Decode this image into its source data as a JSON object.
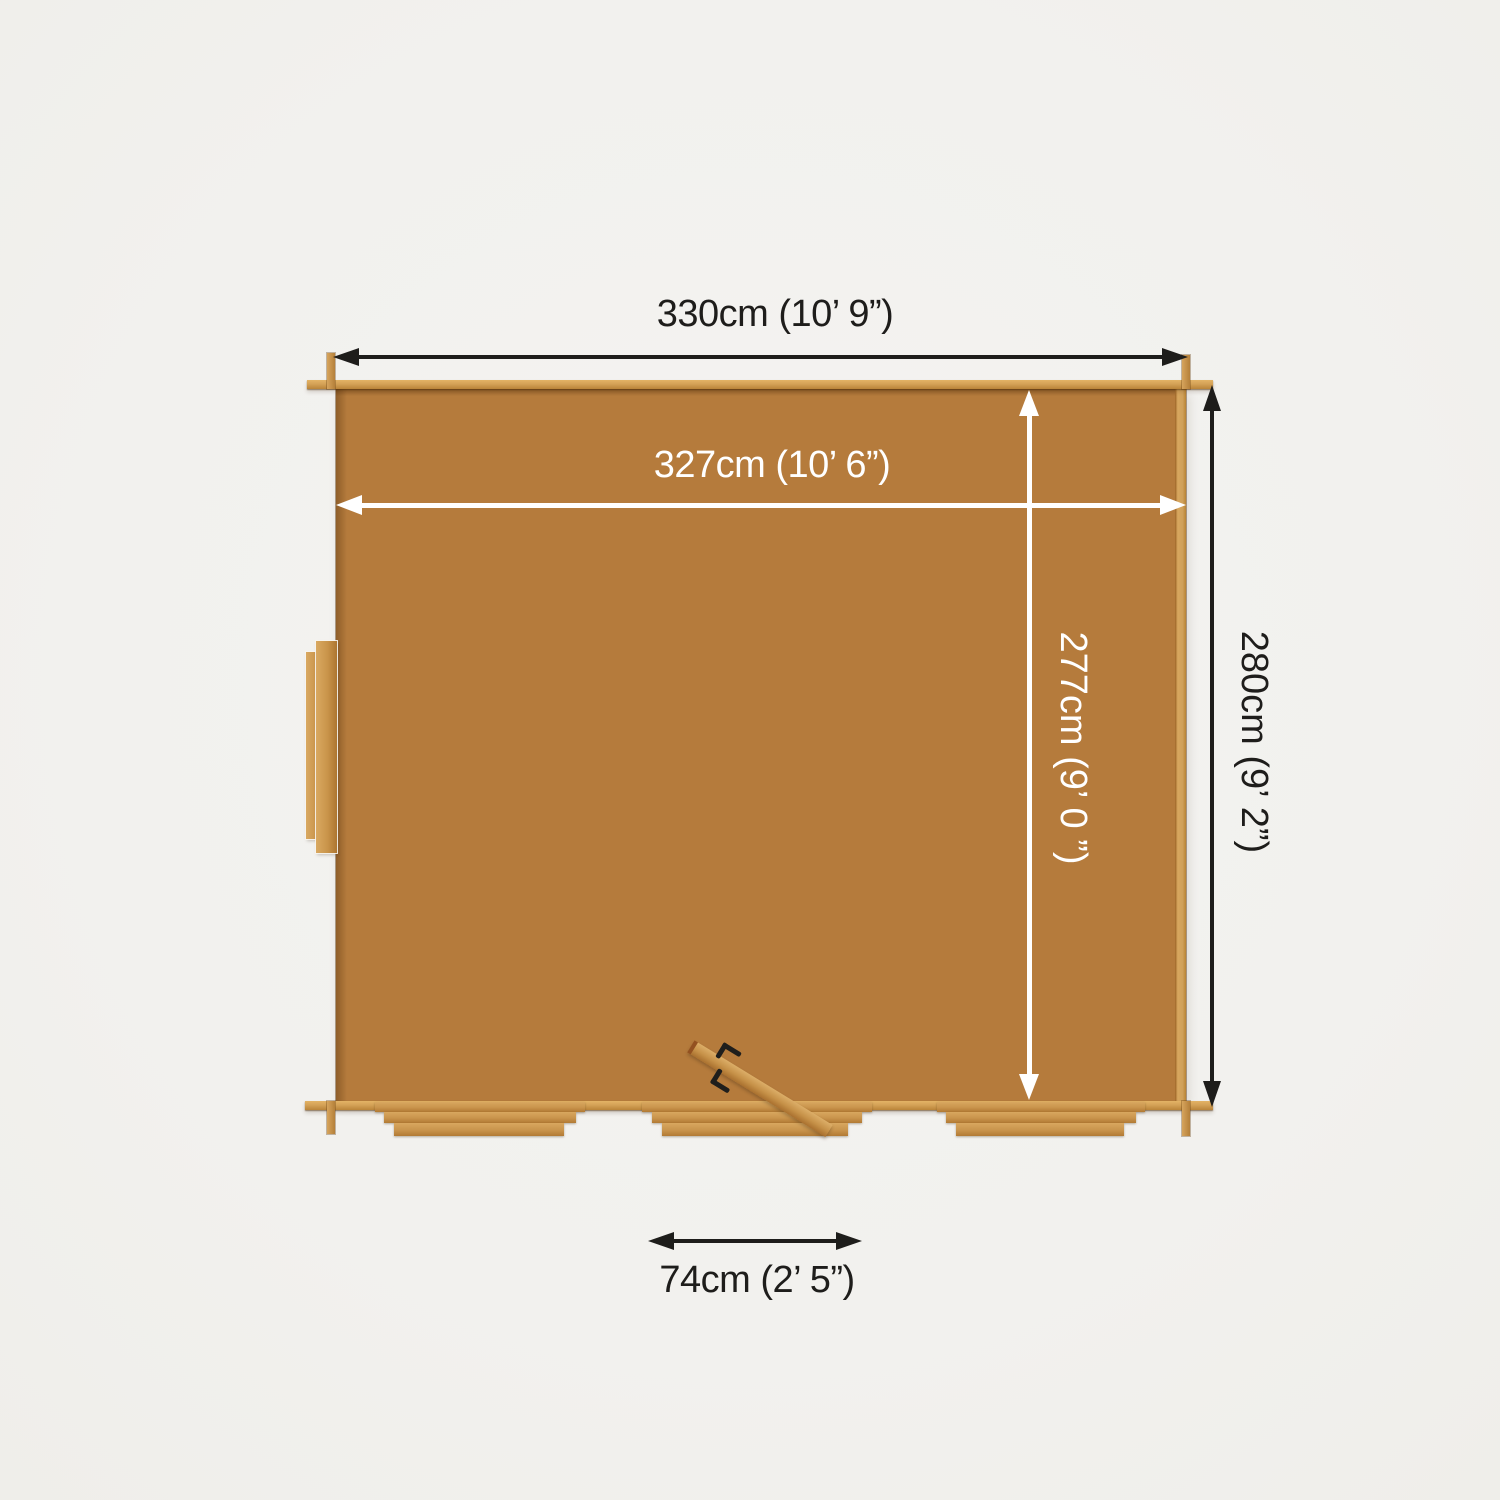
{
  "diagram": {
    "type": "garden-building-top-view-dimension-diagram",
    "labels": {
      "external_width": "330cm (10’ 9”)",
      "internal_width": "327cm (10’ 6”)",
      "internal_depth": "277cm (9’ 0 ”)",
      "external_depth": "280cm (9’ 2”)",
      "door_width": "74cm (2’ 5”)"
    },
    "colors": {
      "background": "#f2f1ee",
      "wood_mid": "#b57b3c",
      "wood_light": "#d4a257",
      "annotation_dark": "#1e1d1b",
      "annotation_light": "#ffffff"
    }
  }
}
